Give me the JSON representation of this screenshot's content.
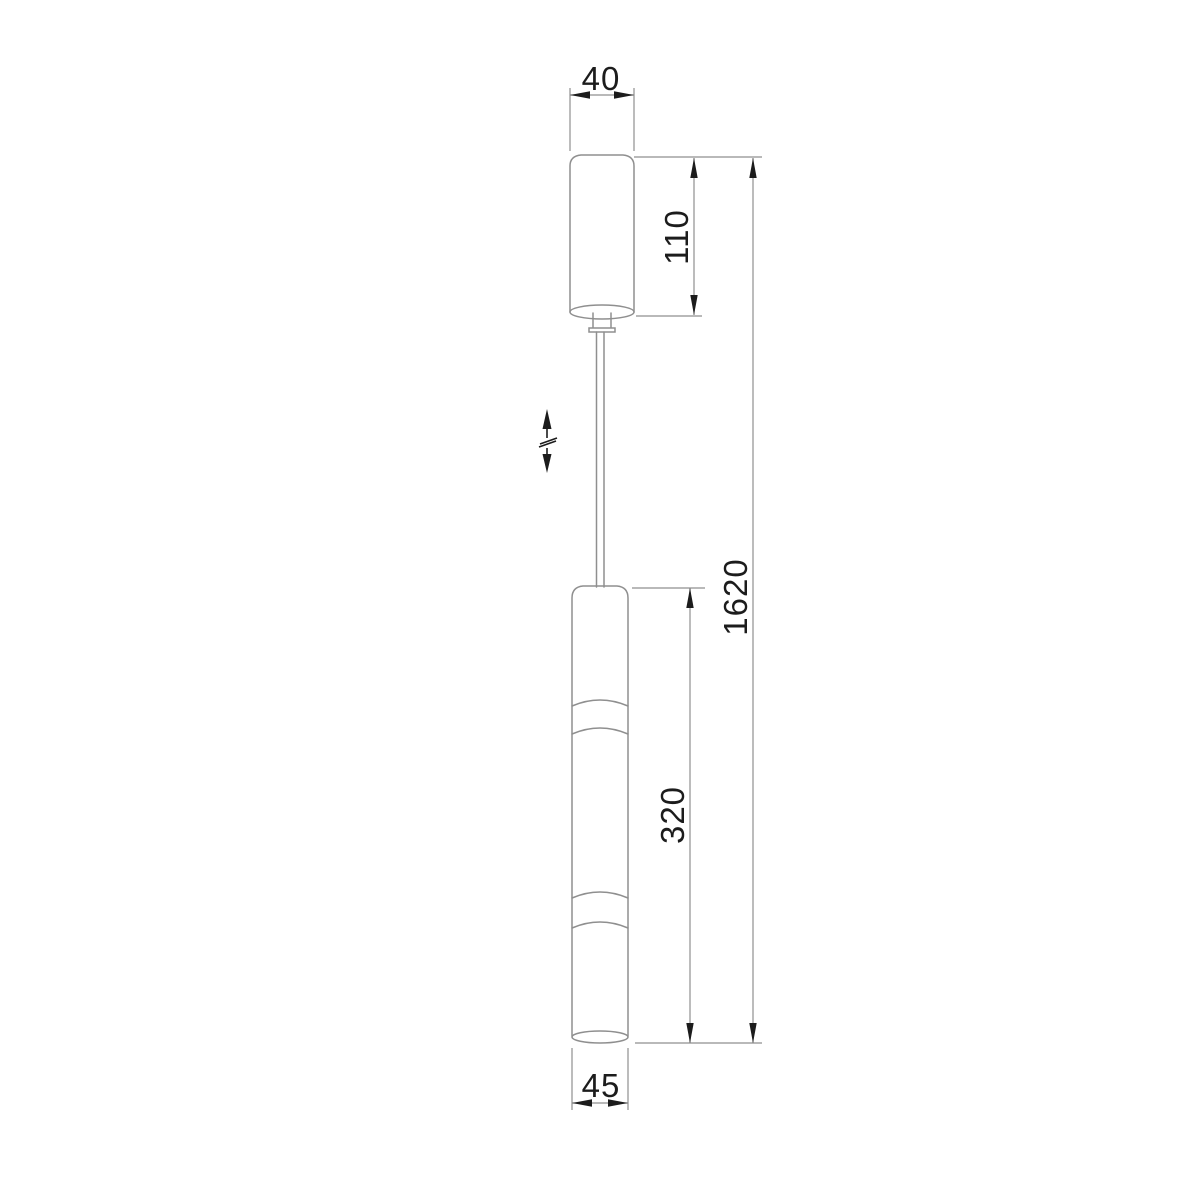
{
  "drawing": {
    "type": "technical-dimension-drawing",
    "subject": "suspended-pendant-light-fixture",
    "colors": {
      "background": "#ffffff",
      "object_line": "#8f8f8f",
      "dimension_line": "#8f8f8f",
      "annotation": "#1c1c1c"
    },
    "labels": {
      "canopy_width": "40",
      "canopy_height": "110",
      "total_height": "1620",
      "body_length": "320",
      "body_diameter": "45"
    },
    "dimensions": [
      {
        "id": "canopy-width",
        "label": "40",
        "orientation": "horizontal",
        "measures": "ceiling canopy diameter"
      },
      {
        "id": "canopy-height",
        "label": "110",
        "orientation": "vertical",
        "measures": "ceiling canopy height"
      },
      {
        "id": "total-height",
        "label": "1620",
        "orientation": "vertical",
        "measures": "overall suspension height"
      },
      {
        "id": "body-length",
        "label": "320",
        "orientation": "vertical",
        "measures": "lamp tube length"
      },
      {
        "id": "body-diameter",
        "label": "45",
        "orientation": "horizontal",
        "measures": "lamp tube diameter"
      }
    ],
    "symbols": {
      "height_adjustment": "vertical-double-arrow-with-break-icon"
    }
  }
}
